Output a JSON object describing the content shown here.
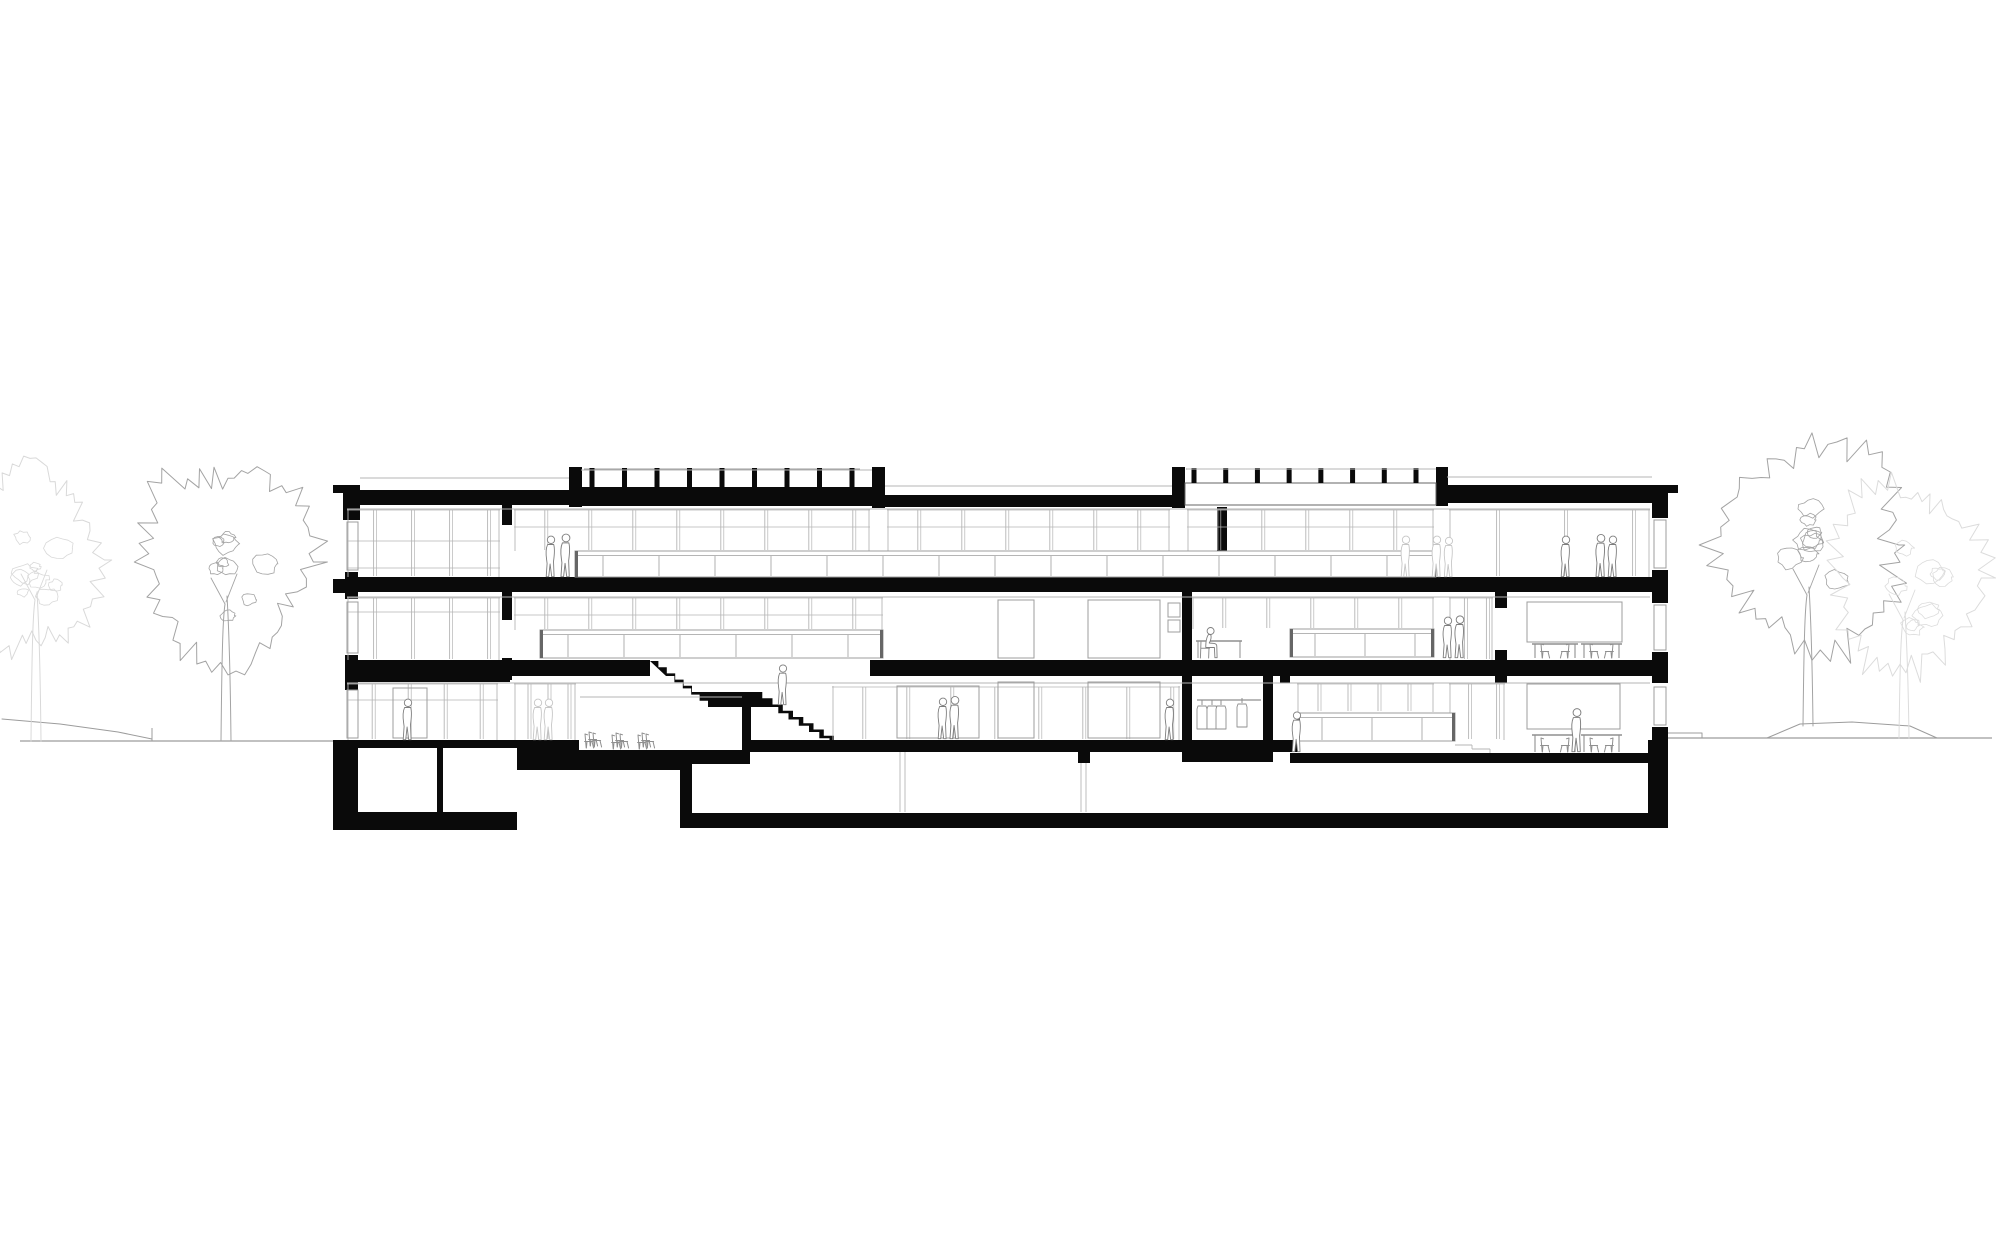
{
  "canvas": {
    "w": 2000,
    "h": 1245,
    "bg": "#ffffff"
  },
  "palette": {
    "ink": "#0a0a0a",
    "line": "#9c9c9c",
    "lite": "#b5b5b5",
    "faint": "#d9d9d9",
    "tree": "#a3a3a3",
    "people": "#7e7e7e",
    "people_faint": "#c6c6c6",
    "furn": "#8f8f8f",
    "band_edge": "#666666"
  },
  "ground": {
    "left_line": [
      20,
      741,
      333,
      741
    ],
    "left_slope": [
      [
        2,
        719
      ],
      [
        60,
        724
      ],
      [
        118,
        732
      ],
      [
        152,
        739
      ]
    ],
    "left_tick": [
      152,
      728,
      152,
      741
    ],
    "right_line": [
      1668,
      738,
      1992,
      738
    ],
    "right_step": [
      [
        1668,
        733
      ],
      [
        1702,
        733
      ],
      [
        1702,
        738
      ]
    ],
    "mound": [
      [
        1767,
        738
      ],
      [
        1800,
        724
      ],
      [
        1852,
        722
      ],
      [
        1910,
        726
      ],
      [
        1937,
        738
      ]
    ]
  },
  "trees": [
    {
      "id": "tree-far-left-faint",
      "cx": 36,
      "cy": 560,
      "rx": 62,
      "ry": 92,
      "seed": 7,
      "color": "#d9d9d9",
      "trunk": [
        36,
        741,
        600
      ]
    },
    {
      "id": "tree-left",
      "cx": 228,
      "cy": 562,
      "rx": 84,
      "ry": 100,
      "seed": 3,
      "color": "#a3a3a3",
      "trunk": [
        226,
        741,
        604
      ]
    },
    {
      "id": "tree-right",
      "cx": 1812,
      "cy": 545,
      "rx": 90,
      "ry": 100,
      "seed": 11,
      "color": "#a3a3a3",
      "trunk": [
        1808,
        726,
        595
      ]
    },
    {
      "id": "tree-far-right-faint",
      "cx": 1906,
      "cy": 578,
      "rx": 72,
      "ry": 92,
      "seed": 21,
      "color": "#dcdcdc",
      "trunk": [
        1904,
        738,
        620
      ]
    }
  ],
  "blacks": [
    [
      333,
      485,
      27,
      8
    ],
    [
      343,
      487,
      17,
      33
    ],
    [
      345,
      490,
      234,
      15
    ],
    [
      569,
      467,
      13,
      40
    ],
    [
      872,
      467,
      13,
      41
    ],
    [
      569,
      487,
      316,
      19
    ],
    [
      885,
      495,
      299,
      12
    ],
    [
      1172,
      467,
      13,
      41
    ],
    [
      1436,
      467,
      12,
      39
    ],
    [
      1447,
      485,
      221,
      18
    ],
    [
      1652,
      485,
      26,
      8
    ],
    [
      1652,
      487,
      16,
      31
    ],
    [
      333,
      579,
      12,
      14
    ],
    [
      345,
      577,
      1323,
      15
    ],
    [
      345,
      660,
      305,
      16
    ],
    [
      345,
      660,
      165,
      22
    ],
    [
      870,
      660,
      798,
      16
    ],
    [
      502,
      505,
      10,
      20
    ],
    [
      502,
      592,
      10,
      28
    ],
    [
      502,
      658,
      10,
      22
    ],
    [
      1217,
      507,
      10,
      72
    ],
    [
      1182,
      590,
      10,
      72
    ],
    [
      1495,
      592,
      12,
      16
    ],
    [
      1495,
      650,
      12,
      33
    ],
    [
      1652,
      570,
      16,
      33
    ],
    [
      1652,
      652,
      16,
      31
    ],
    [
      1652,
      727,
      16,
      30
    ],
    [
      345,
      572,
      13,
      27
    ],
    [
      345,
      655,
      13,
      35
    ],
    [
      1280,
      660,
      10,
      23
    ],
    [
      333,
      740,
      25,
      90
    ],
    [
      345,
      740,
      172,
      90
    ],
    [
      517,
      740,
      163,
      30
    ],
    [
      680,
      740,
      620,
      12
    ],
    [
      680,
      740,
      12,
      88
    ],
    [
      680,
      813,
      985,
      15
    ],
    [
      1078,
      748,
      12,
      16
    ],
    [
      1290,
      753,
      378,
      10
    ],
    [
      1648,
      740,
      20,
      88
    ],
    [
      1182,
      673,
      10,
      79
    ],
    [
      1263,
      673,
      10,
      79
    ],
    [
      1182,
      750,
      91,
      12
    ]
  ],
  "whites": [
    {
      "r": [
        1185,
        483,
        251,
        22
      ],
      "stroke": "#666666"
    },
    {
      "r": [
        358,
        748,
        79,
        64
      ]
    },
    {
      "r": [
        443,
        748,
        74,
        64
      ]
    },
    {
      "r": [
        692,
        752,
        206,
        61
      ]
    },
    {
      "r": [
        907,
        752,
        56,
        61
      ]
    },
    {
      "r": [
        977,
        763,
        671,
        50
      ]
    },
    {
      "r": [
        579,
        697,
        163,
        53
      ]
    }
  ],
  "blacks2": [
    [
      742,
      697,
      9,
      55
    ],
    [
      680,
      750,
      70,
      14
    ]
  ],
  "stair": {
    "flights": [
      {
        "x0": 650,
        "y0": 661,
        "x1": 692,
        "y1": 692,
        "n": 5
      },
      {
        "x0": 752,
        "y0": 692,
        "x1": 834,
        "y1": 742,
        "n": 8
      }
    ],
    "landing_x1": 752,
    "tail": [
      850,
      742,
      757
    ],
    "offset": [
      16,
      15
    ]
  },
  "rail_posts": [
    {
      "x0": 592,
      "x1": 852,
      "n": 9,
      "y0": 468,
      "y1": 487,
      "w": 5
    },
    {
      "x0": 1194,
      "x1": 1416,
      "n": 8,
      "y0": 468,
      "y1": 483,
      "w": 5
    }
  ],
  "graylines": [
    [
      360,
      478,
      569,
      478
    ],
    [
      581,
      470,
      872,
      470
    ],
    [
      885,
      486,
      1172,
      486
    ],
    [
      1187,
      469,
      1436,
      469
    ],
    [
      1447,
      477,
      1652,
      477
    ],
    [
      347,
      509,
      1650,
      509
    ],
    [
      347,
      597,
      1650,
      597
    ],
    [
      347,
      683,
      1650,
      683
    ],
    [
      580,
      697,
      742,
      697
    ],
    [
      900,
      752,
      900,
      812
    ],
    [
      905,
      752,
      905,
      812
    ],
    [
      1081,
      763,
      1081,
      812
    ],
    [
      1086,
      763,
      1086,
      812
    ],
    [
      1455,
      745,
      1472,
      745
    ],
    [
      1472,
      745,
      1472,
      749
    ],
    [
      1472,
      749,
      1490,
      749
    ],
    [
      1490,
      749,
      1490,
      753
    ]
  ],
  "window_bands": [
    {
      "x0": 347,
      "x1": 500,
      "y0": 509,
      "y1": 577,
      "sp": 38,
      "tr": [
        541,
        568
      ]
    },
    {
      "x0": 514,
      "x1": 870,
      "y0": 509,
      "y1": 551,
      "sp": 44,
      "tr": [
        527
      ]
    },
    {
      "x0": 887,
      "x1": 1170,
      "y0": 509,
      "y1": 551,
      "sp": 44,
      "tr": [
        527
      ]
    },
    {
      "x0": 1187,
      "x1": 1434,
      "y0": 509,
      "y1": 551,
      "sp": 44,
      "tr": [
        527
      ]
    },
    {
      "x0": 1449,
      "x1": 1650,
      "y0": 509,
      "y1": 577,
      "sp": 68,
      "tr": []
    },
    {
      "x0": 347,
      "x1": 500,
      "y0": 597,
      "y1": 660,
      "sp": 38,
      "tr": [
        612
      ]
    },
    {
      "x0": 514,
      "x1": 883,
      "y0": 597,
      "y1": 630,
      "sp": 44,
      "tr": [
        615
      ]
    },
    {
      "x0": 1192,
      "x1": 1434,
      "y0": 597,
      "y1": 629,
      "sp": 44,
      "tr": []
    },
    {
      "x0": 1449,
      "x1": 1493,
      "y0": 597,
      "y1": 660,
      "sp": 22,
      "tr": []
    },
    {
      "x0": 347,
      "x1": 498,
      "y0": 683,
      "y1": 740,
      "sp": 36,
      "tr": [
        700
      ]
    },
    {
      "x0": 514,
      "x1": 576,
      "y0": 683,
      "y1": 740,
      "sp": 20,
      "tr": []
    },
    {
      "x0": 832,
      "x1": 1180,
      "y0": 686,
      "y1": 740,
      "sp": 44,
      "tr": []
    },
    {
      "x0": 1297,
      "x1": 1434,
      "y0": 683,
      "y1": 712,
      "sp": 30,
      "tr": []
    },
    {
      "x0": 1449,
      "x1": 1505,
      "y0": 683,
      "y1": 740,
      "sp": 28,
      "tr": []
    }
  ],
  "balustrade_bands": [
    {
      "x0": 575,
      "x1": 1436,
      "y0": 551,
      "y1": 577,
      "sp": 56
    },
    {
      "x0": 540,
      "x1": 883,
      "y0": 630,
      "y1": 658,
      "sp": 56
    },
    {
      "x0": 1290,
      "x1": 1434,
      "y0": 629,
      "y1": 657,
      "sp": 50
    },
    {
      "x0": 1297,
      "x1": 1455,
      "y0": 713,
      "y1": 741,
      "sp": 50
    }
  ],
  "grayrects": [
    [
      998,
      600,
      36,
      58
    ],
    [
      1088,
      600,
      72,
      58
    ],
    [
      998,
      682,
      36,
      56
    ],
    [
      1088,
      682,
      72,
      56
    ],
    [
      1527,
      602,
      95,
      40
    ],
    [
      1527,
      684,
      93,
      45
    ],
    [
      897,
      686,
      82,
      52
    ],
    [
      393,
      688,
      34,
      50
    ],
    [
      1168,
      603,
      12,
      14
    ],
    [
      1168,
      620,
      12,
      12
    ],
    [
      1654,
      520,
      12,
      48
    ],
    [
      1654,
      605,
      12,
      45
    ],
    [
      1654,
      687,
      12,
      38
    ],
    [
      347,
      522,
      11,
      48
    ],
    [
      347,
      602,
      11,
      51
    ],
    [
      347,
      690,
      11,
      48
    ]
  ],
  "people": [
    {
      "x": 551,
      "y": 577,
      "pose": "stand",
      "tone": "normal",
      "s": 1
    },
    {
      "x": 566,
      "y": 577,
      "pose": "stand",
      "tone": "normal",
      "s": 1.05
    },
    {
      "x": 1406,
      "y": 577,
      "pose": "stand",
      "tone": "faint",
      "s": 1
    },
    {
      "x": 1437,
      "y": 577,
      "pose": "stand",
      "tone": "faint",
      "s": 1
    },
    {
      "x": 1449,
      "y": 577,
      "pose": "stand",
      "tone": "faint",
      "s": 0.97
    },
    {
      "x": 1566,
      "y": 577,
      "pose": "stand",
      "tone": "normal",
      "s": 1
    },
    {
      "x": 1601,
      "y": 577,
      "pose": "stand",
      "tone": "normal",
      "s": 1.04
    },
    {
      "x": 1613,
      "y": 577,
      "pose": "stand",
      "tone": "normal",
      "s": 1
    },
    {
      "x": 1448,
      "y": 658,
      "pose": "stand",
      "tone": "normal",
      "s": 1
    },
    {
      "x": 1460,
      "y": 658,
      "pose": "stand",
      "tone": "normal",
      "s": 1.03
    },
    {
      "x": 1208,
      "y": 658,
      "pose": "sit",
      "tone": "normal",
      "s": 1
    },
    {
      "x": 783,
      "y": 705,
      "pose": "stand",
      "tone": "normal",
      "s": 0.98
    },
    {
      "x": 408,
      "y": 740,
      "pose": "stand",
      "tone": "normal",
      "s": 1
    },
    {
      "x": 538,
      "y": 740,
      "pose": "stand",
      "tone": "faint",
      "s": 1
    },
    {
      "x": 549,
      "y": 740,
      "pose": "stand",
      "tone": "faint",
      "s": 1
    },
    {
      "x": 943,
      "y": 739,
      "pose": "stand",
      "tone": "normal",
      "s": 1
    },
    {
      "x": 955,
      "y": 739,
      "pose": "stand",
      "tone": "normal",
      "s": 1.04
    },
    {
      "x": 1170,
      "y": 740,
      "pose": "stand",
      "tone": "normal",
      "s": 1
    },
    {
      "x": 1297,
      "y": 752,
      "pose": "stand",
      "tone": "normal",
      "s": 0.98
    },
    {
      "x": 1577,
      "y": 752,
      "pose": "stand",
      "tone": "normal",
      "s": 1.06
    }
  ],
  "furniture": {
    "tables": [
      {
        "x": 1532,
        "w": 46,
        "top": 644,
        "floor": 658
      },
      {
        "x": 1581,
        "w": 41,
        "top": 644,
        "floor": 658
      },
      {
        "x": 1532,
        "w": 46,
        "top": 735,
        "floor": 752
      },
      {
        "x": 1581,
        "w": 41,
        "top": 735,
        "floor": 752
      }
    ],
    "desk": {
      "x": 1196,
      "w": 46,
      "top": 641,
      "floor": 658
    },
    "chair_stacks": [
      {
        "x": 585,
        "y": 748
      },
      {
        "x": 612,
        "y": 749
      },
      {
        "x": 638,
        "y": 749
      }
    ],
    "clothes_rail": {
      "x0": 1197,
      "y": 700,
      "x1": 1261,
      "items": [
        [
          1202,
          700
        ],
        [
          1212,
          700
        ],
        [
          1221,
          700
        ],
        [
          1242,
          698
        ]
      ]
    }
  }
}
